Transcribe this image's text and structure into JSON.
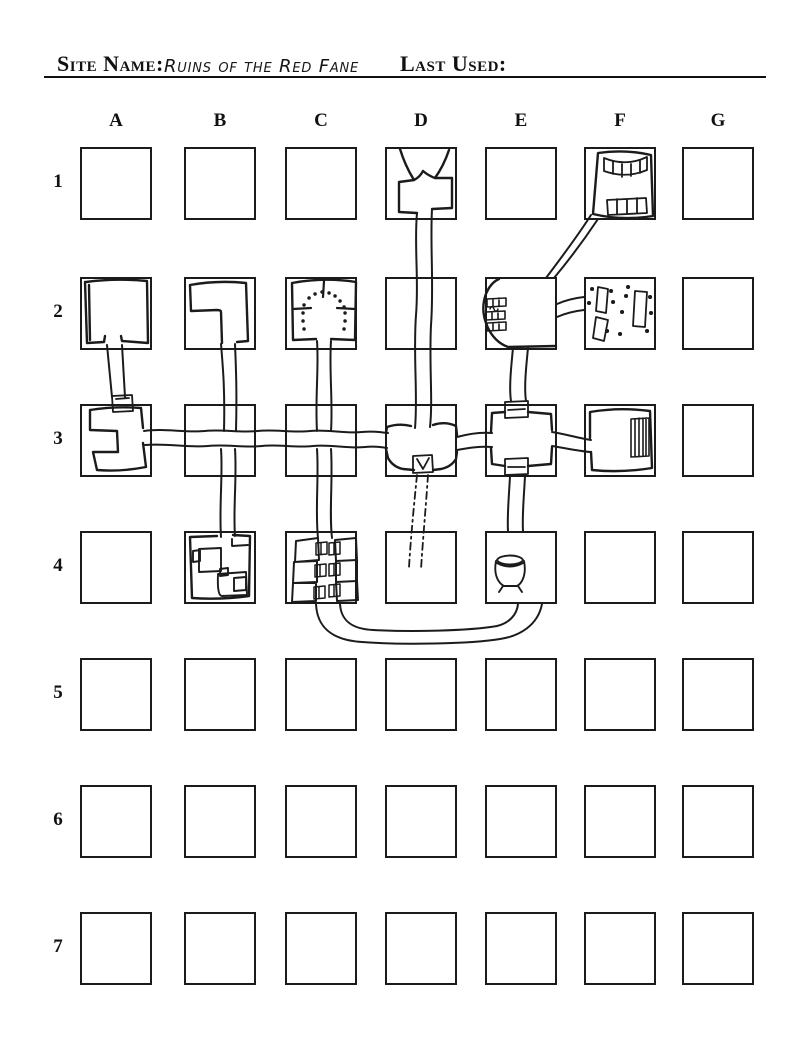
{
  "header": {
    "site_name_label": "Site Name:",
    "site_name_value": "Ruins of the Red Fane",
    "last_used_label": "Last Used:"
  },
  "grid": {
    "column_labels": [
      "A",
      "B",
      "C",
      "D",
      "E",
      "F",
      "G"
    ],
    "row_labels": [
      "1",
      "2",
      "3",
      "4",
      "5",
      "6",
      "7"
    ]
  },
  "map": {
    "ink_color": "#1b1b1b",
    "strokes": [
      {
        "n": "d1-entrance-funnel",
        "d": "M 400,149 C 404,162 409,172 414,180 M 449,150 C 445,162 440,171 435,178 M 414,180 Q 420,177 423,171 M 435,178 Q 429,176 423,171",
        "w": 2.4
      },
      {
        "n": "d1-room",
        "d": "M 414,180 L 399,182 L 399,212 L 417,213 M 435,178 L 452,178 L 452,208 L 432,209",
        "w": 2.4
      },
      {
        "n": "corridor-d1-d3",
        "d": "M 417,213 C 414,245 419,280 416,315 C 413,355 418,395 415,428 M 432,209 C 430,245 434,285 431,325 C 429,365 433,400 430,427",
        "w": 2
      },
      {
        "n": "f1-room",
        "d": "M 598,153 Q 625,149 651,155 L 653,216 Q 622,221 593,214 Z",
        "w": 2.4
      },
      {
        "n": "f1-stairs-top",
        "d": "M 604,158 Q 626,167 647,157 M 604,171 Q 626,179 647,170 M 604,158 L 604,171 M 647,157 L 647,170 M 613,161 L 613,174 M 622,164 L 622,177 M 631,164 L 631,176 M 640,161 L 640,173",
        "w": 1.8
      },
      {
        "n": "f1-stairs-bottom",
        "d": "M 607,200 L 646,198 L 647,213 L 608,215 Z M 617,199 L 617,214 M 627,199 L 627,214 M 637,198 L 637,213",
        "w": 1.8
      },
      {
        "n": "corridor-f1-e2-diagonal",
        "d": "M 591,215 C 577,237 561,258 546,278 M 598,219 C 584,240 569,260 554,278",
        "w": 2
      },
      {
        "n": "a2-room",
        "d": "M 86,282 Q 116,278 147,281 L 148,343 L 122,341 L 121,336 M 105,336 L 104,342 L 87,343 L 85,282 M 89,285 L 90,340",
        "w": 2.4
      },
      {
        "n": "corridor-a2-a3",
        "d": "M 107,345 C 109,365 111,385 112,397 M 122,345 C 123,365 124,382 125,397",
        "w": 2
      },
      {
        "n": "a3-door",
        "d": "M 112,396 L 132,395 L 133,411 L 113,412 Z M 116,399 L 129,398",
        "w": 1.8
      },
      {
        "n": "b2-room",
        "d": "M 190,285 Q 218,280 246,283 L 248,341 L 237,342 M 222,343 L 221,312 Q 221,310 217,310 L 191,311 L 190,285",
        "w": 2.4
      },
      {
        "n": "corridor-b2-b3",
        "d": "M 221,344 C 223,368 225,390 224,431 M 235,344 C 236,368 237,392 236,431",
        "w": 2
      },
      {
        "n": "corridor-b3-b4",
        "d": "M 221,449 C 223,475 219,505 221,537 M 235,449 C 237,478 233,508 235,536",
        "w": 2
      },
      {
        "n": "c2-room",
        "d": "M 292,283 Q 324,277 356,282 L 355,340 L 331,339 M 316,339 L 293,340 L 292,283",
        "w": 2.4
      },
      {
        "n": "c2-shrine-walls",
        "d": "M 324,281 L 323,297 M 293,309 L 311,308 M 337,308 L 355,309",
        "w": 2.2
      },
      {
        "n": "c2-arch-dots",
        "d": "M 303,313 l .1,0 M 304,305 l .1,0 M 309,298 l .1,0 M 315,294 l .1,0 M 322,292 l .1,0 M 329,293 l .1,0 M 335,296 l .1,0 M 340,301 l .1,0 M 344,307 l .1,0 M 345,313 l .1,0 M 303,321 l .1,0 M 345,321 l .1,0 M 304,329 l .1,0 M 344,329 l .1,0",
        "w": 3.4
      },
      {
        "n": "corridor-c2-c3",
        "d": "M 317,341 C 319,368 315,398 317,431 M 331,341 C 329,370 333,402 331,431",
        "w": 2
      },
      {
        "n": "corridor-c3-c4",
        "d": "M 317,449 C 319,478 315,510 318,538 M 331,449 C 333,480 329,512 332,538",
        "w": 2
      },
      {
        "n": "a3-room",
        "d": "M 90,410 Q 116,406 141,408 L 143,428 M 143,443 L 146,467 Q 120,472 97,470 L 93,452 L 118,452 L 117,431 L 90,430 L 90,410",
        "w": 2.4
      },
      {
        "n": "corridor-a3-d3",
        "d": "M 144,431 C 165,428 185,433 205,431 C 222,429 240,433 258,431 C 275,429 292,433 310,431 C 328,429 345,434 362,432 C 372,431 380,432 388,433 M 145,445 C 168,443 188,448 208,446 C 226,444 244,448 262,446 C 278,444 295,448 313,446 C 330,444 348,449 365,447 C 374,446 381,447 387,448",
        "w": 2
      },
      {
        "n": "d3-room",
        "d": "M 387,427 Q 399,423 411,426 M 433,425 Q 445,421 456,426 M 387,427 L 386,433 M 386,449 L 388,458 Q 393,467 403,469 L 414,470 M 456,426 L 457,435 M 457,452 L 456,459 Q 451,467 441,469 L 433,470",
        "w": 2.4
      },
      {
        "n": "d3-trapdoor",
        "d": "M 413,456 L 432,455 L 433,472 L 413,473 Z M 417,459 L 423,469 L 429,458",
        "w": 1.8
      },
      {
        "n": "corridor-d3-d4-secret",
        "d": "M 417,475 C 414,505 411,535 409,567 M 428,475 C 426,505 423,538 421,569",
        "w": 1.8,
        "da": "7 4 2 4"
      },
      {
        "n": "corridor-d3-e3",
        "d": "M 457,437 C 468,434 480,432 492,433 M 457,450 C 468,448 480,446 492,447",
        "w": 2
      },
      {
        "n": "e3-room",
        "d": "M 492,413 L 505,412 M 528,412 L 551,414 L 552,430 M 552,447 L 551,464 L 528,466 M 505,466 L 492,464 L 491,448 M 491,432 L 492,413",
        "w": 2.4
      },
      {
        "n": "e3-door-top",
        "d": "M 505,402 L 528,401 L 528,417 L 505,418 Z M 508,410 L 525,409",
        "w": 1.8
      },
      {
        "n": "e3-door-bottom",
        "d": "M 505,459 L 528,458 L 528,474 L 505,475 Z M 508,467 L 525,467",
        "w": 1.8
      },
      {
        "n": "corridor-e2-e3",
        "d": "M 513,348 C 511,368 509,388 511,401 M 528,348 C 526,368 524,388 526,401",
        "w": 2
      },
      {
        "n": "corridor-e3-e4",
        "d": "M 510,476 C 509,496 507,516 508,531 M 525,476 C 524,496 522,516 523,531",
        "w": 2
      },
      {
        "n": "e2-room",
        "d": "M 499,279 C 492,282 486,290 484,301 C 481,317 489,340 508,347 L 556,346",
        "w": 2.4
      },
      {
        "n": "e2-stairs",
        "d": "M 487,299 L 506,298 L 506,306 L 487,307 Z M 493,299 L 493,306 M 499,298 L 499,306 M 486,312 L 505,311 L 505,319 L 486,320 Z M 492,312 L 492,319 M 498,311 L 498,319 M 487,323 L 506,322 L 506,330 L 487,331 Z M 493,323 L 493,330 M 499,322 L 499,330",
        "w": 1.6
      },
      {
        "n": "e2-note-scribble",
        "d": "M 490,309 c 1,-3 3,-3 4,0 c 1,3 3,3 4,0",
        "w": 1.4
      },
      {
        "n": "corridor-e2-f2",
        "d": "M 557,304 C 566,300 575,298 584,297 M 557,317 C 566,313 575,311 584,310",
        "w": 2
      },
      {
        "n": "f2-rubble-slabs",
        "d": "M 598,287 L 608,289 L 606,313 L 596,311 Z M 635,291 L 647,292 L 645,327 L 633,326 Z M 596,317 L 608,320 L 604,341 L 593,338 Z",
        "w": 1.8
      },
      {
        "n": "f2-rubble-stones",
        "d": "M 592,289 l .1,0 M 611,291 l .1,0 M 628,287 l .1,0 M 589,303 l .1,0 M 613,302 l .1,0 M 626,296 l .1,0 M 650,297 l .1,0 M 622,312 l .1,0 M 651,313 l .1,0 M 607,331 l .1,0 M 620,334 l .1,0 M 647,331 l .1,0",
        "w": 4
      },
      {
        "n": "f3-room",
        "d": "M 590,438 L 590,412 Q 620,407 650,411 L 652,468 Q 621,473 592,470 L 591,452",
        "w": 2.4
      },
      {
        "n": "f3-stairs",
        "d": "M 631,419 L 649,418 L 649,456 L 631,457 Z M 635,419 L 635,456 M 639,418 L 639,456 M 643,418 L 643,456 M 646,418 L 646,456",
        "w": 1.6
      },
      {
        "n": "corridor-e3-f3",
        "d": "M 552,432 C 565,434 578,438 591,440 M 552,446 C 565,448 578,451 590,452",
        "w": 2
      },
      {
        "n": "b4-room",
        "d": "M 190,537 L 217,536 M 233,535 L 250,536 L 249,596 Q 220,600 192,598 L 190,537",
        "w": 2.4
      },
      {
        "n": "b4-inner-room-1",
        "d": "M 199,549 L 221,548 L 221,571 L 199,572 Z M 193,551 L 200,550 L 200,561 L 193,562 Z",
        "w": 1.9
      },
      {
        "n": "b4-inner-room-2",
        "d": "M 218,574 L 246,572 L 247,595 L 222,596 Q 217,596 218,574 Z M 234,578 L 246,577 L 246,590 L 234,591 Z M 220,569 L 228,568 L 228,575 L 220,576 Z",
        "w": 1.9
      },
      {
        "n": "b4-inner-wall",
        "d": "M 248,545 L 232,546 L 232,539",
        "w": 1.9
      },
      {
        "n": "c4-crypt-niches",
        "d": "M 296,541 L 318,538 L 319,560 L 295,562 Z M 294,562 L 317,561 L 317,582 L 293,583 Z M 293,583 L 316,583 L 316,601 L 292,602 Z M 335,540 L 356,538 L 357,560 L 336,561 Z M 336,561 L 357,560 L 357,581 L 336,582 Z M 336,582 L 357,581 L 358,600 L 337,601 Z",
        "w": 2
      },
      {
        "n": "c4-crypt-doors",
        "d": "M 316,543 L 327,542 L 327,554 L 316,555 Z M 321,543 L 321,554 M 315,565 L 326,564 L 326,576 L 315,577 Z M 320,565 L 320,576 M 314,587 L 325,586 L 325,598 L 314,599 Z M 319,587 L 319,598 M 329,543 L 340,542 L 340,554 L 329,555 Z M 334,543 L 334,554 M 329,564 L 340,563 L 340,575 L 329,576 Z M 334,564 L 334,575 M 329,585 L 340,584 L 340,596 L 329,597 Z M 334,585 L 334,596",
        "w": 1.5
      },
      {
        "n": "corridor-c4-e4-loop",
        "d": "M 316,604 C 317,626 330,640 362,642 C 400,645 470,644 500,639 C 520,636 538,625 542,604 M 340,604 C 341,620 351,629 373,630 C 410,632 468,631 497,626 C 509,623 517,615 518,604",
        "w": 2
      },
      {
        "n": "e4-cauldron",
        "d": "M 497,560 C 500,554 520,554 523,560 C 520,566 500,566 497,560 M 497,563 Q 510,570 523,563 M 496,561 C 493,577 500,584 504,586 L 517,586 C 521,584 527,576 524,561 M 503,586 L 499,592 M 518,586 L 522,592",
        "w": 1.9
      }
    ]
  }
}
